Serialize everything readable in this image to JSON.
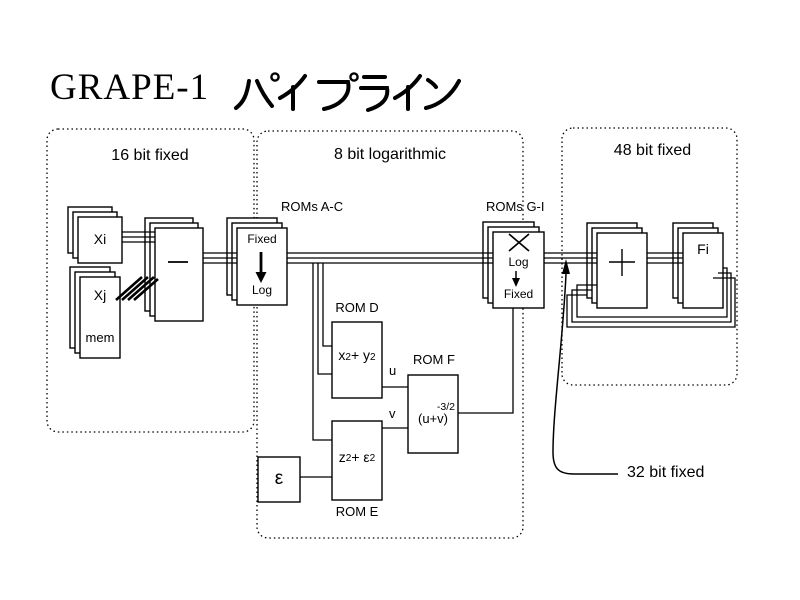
{
  "title": {
    "text": "GRAPE-1 パイプライン",
    "latin": "GRAPE-1",
    "katakana": "パイプライン"
  },
  "regions": {
    "left": {
      "label": "16 bit fixed"
    },
    "middle": {
      "label": "8 bit logarithmic"
    },
    "right": {
      "label": "48 bit fixed"
    }
  },
  "annotations": {
    "roms_ac": "ROMs A-C",
    "roms_gi": "ROMs G-I",
    "rom_d": "ROM D",
    "rom_e": "ROM E",
    "rom_f": "ROM F",
    "bus_32": "32 bit fixed",
    "u": "u",
    "v": "v"
  },
  "blocks": {
    "xi": {
      "label": "Xi"
    },
    "xj": {
      "label": "Xj",
      "sublabel": "mem"
    },
    "subtract": {
      "operator": "−"
    },
    "fixed_to_log": {
      "top": "Fixed",
      "bottom": "Log"
    },
    "multiply_log_to_fixed": {
      "operator": "×",
      "top": "Log",
      "bottom": "Fixed"
    },
    "rom_d": {
      "formula": {
        "b1": "x",
        "s1": "2",
        "b2": "+ y",
        "s2": "2"
      }
    },
    "rom_e": {
      "formula": {
        "b1": "z",
        "s1": "2",
        "b2": "+ ε",
        "s2": "2"
      }
    },
    "rom_f": {
      "formula": {
        "base": "(u+v)",
        "exp": "-3/2"
      }
    },
    "epsilon": {
      "label": "ε"
    },
    "add": {
      "operator": "+"
    },
    "fi": {
      "label": "Fi"
    }
  },
  "colors": {
    "ink": "#000000",
    "background": "#ffffff"
  }
}
